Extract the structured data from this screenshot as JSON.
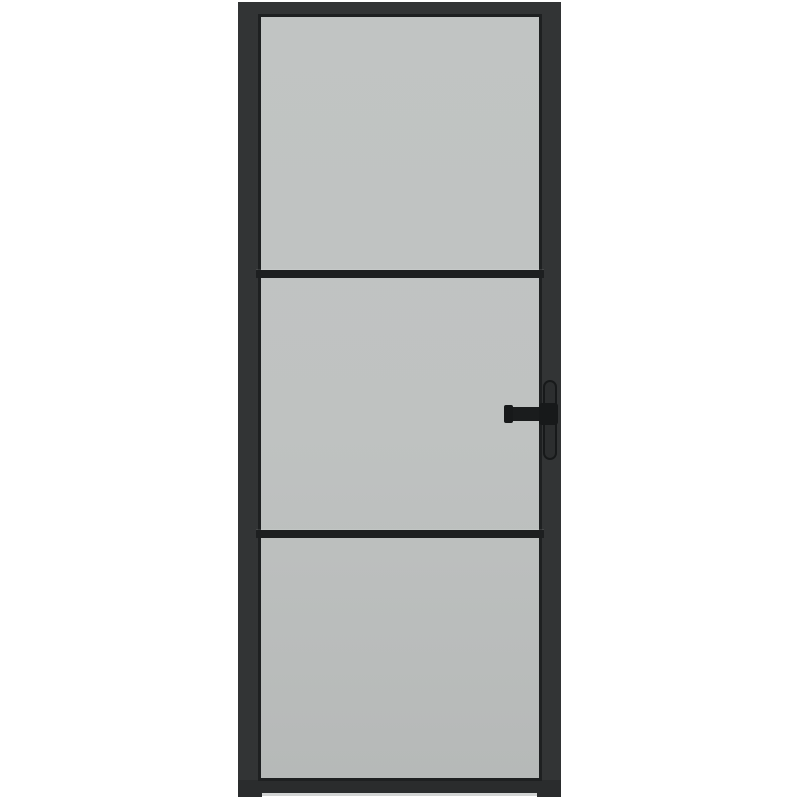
{
  "scene": {
    "type": "product-photo",
    "subject": "interior-glass-door",
    "description": "Black metal-framed interior door with three frosted glass panes separated by two horizontal black glazing bars, lever handle with vertical backplate on the right stile, photographed on a plain white background",
    "background_color": "#ffffff"
  },
  "door": {
    "orientation": "vertical",
    "frame_color": "#323435",
    "frame_bottom_rail_color": "#2a2c2d",
    "glazing_bead_color": "#1e2021",
    "glass_pane_count": 3,
    "glass_color_top": "#c1c4c3",
    "glass_color_bottom": "#b6b9b8",
    "divider_bar_count": 2,
    "divider_bar_color": "#1d1f20",
    "floor_shadow_color": "#d2d4d4",
    "handle": {
      "side": "right",
      "style": "lever-on-backplate",
      "lever_color": "#1a1c1d",
      "backplate_fill_color": "#2c2e2f",
      "backplate_border_color": "#17191a"
    }
  }
}
